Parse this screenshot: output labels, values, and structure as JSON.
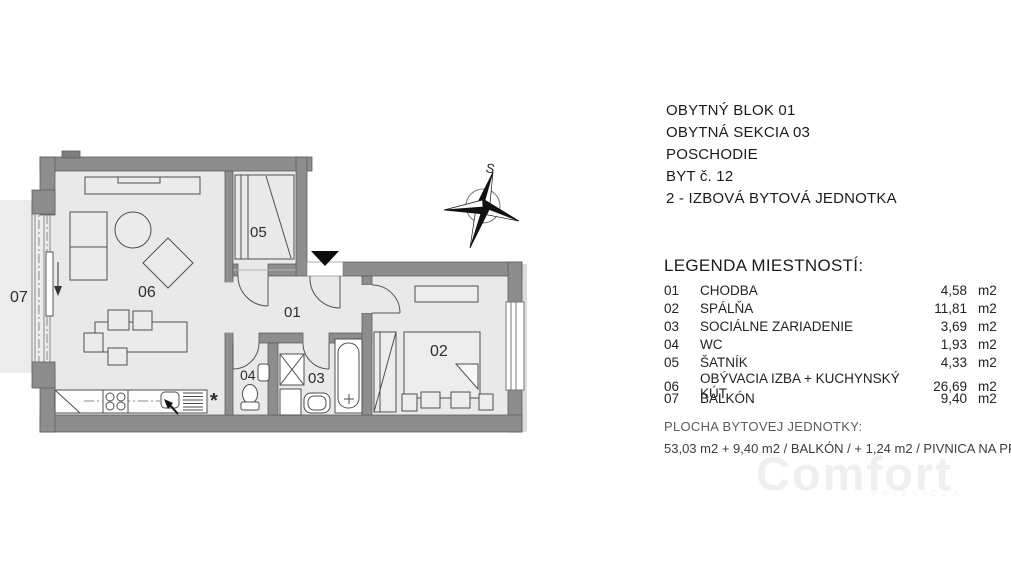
{
  "header": {
    "lines": [
      "OBYTNÝ BLOK 01",
      "OBYTNÁ SEKCIA 03",
      "POSCHODIE",
      "BYT č. 12",
      "2 - IZBOVÁ BYTOVÁ JEDNOTKA"
    ]
  },
  "legend": {
    "title": "LEGENDA MIESTNOSTÍ:",
    "rows": [
      {
        "num": "01",
        "name": "CHODBA",
        "area": "4,58",
        "unit": "m2"
      },
      {
        "num": "02",
        "name": "SPÁLŇA",
        "area": "11,81",
        "unit": "m2"
      },
      {
        "num": "03",
        "name": "SOCIÁLNE ZARIADENIE",
        "area": "3,69",
        "unit": "m2"
      },
      {
        "num": "04",
        "name": "WC",
        "area": "1,93",
        "unit": "m2"
      },
      {
        "num": "05",
        "name": "ŠATNÍK",
        "area": "4,33",
        "unit": "m2"
      },
      {
        "num": "06",
        "name": "OBÝVACIA IZBA + KUCHYNSKÝ KÚT",
        "area": "26,69",
        "unit": "m2"
      },
      {
        "num": "07",
        "name": "BALKÓN",
        "area": "9,40",
        "unit": "m2"
      }
    ]
  },
  "summary": {
    "title": "PLOCHA BYTOVEJ JEDNOTKY:",
    "detail": "53,03 m2 + 9,40 m2 / BALKÓN / + 1,24 m2 / PIVNICA NA PRÍZE"
  },
  "plan": {
    "room_labels": {
      "r01": "01",
      "r02": "02",
      "r03": "03",
      "r04": "04",
      "r05": "05",
      "r06": "06",
      "r07": "07"
    },
    "compass_label": "S",
    "kitchen_note": "*"
  },
  "watermark": {
    "text": "Comfort",
    "subtext": "PRIEVIDZA"
  },
  "colors": {
    "wall": "#8d8d8d",
    "floor": "#e9e9e9",
    "line": "#4f4f4f"
  }
}
